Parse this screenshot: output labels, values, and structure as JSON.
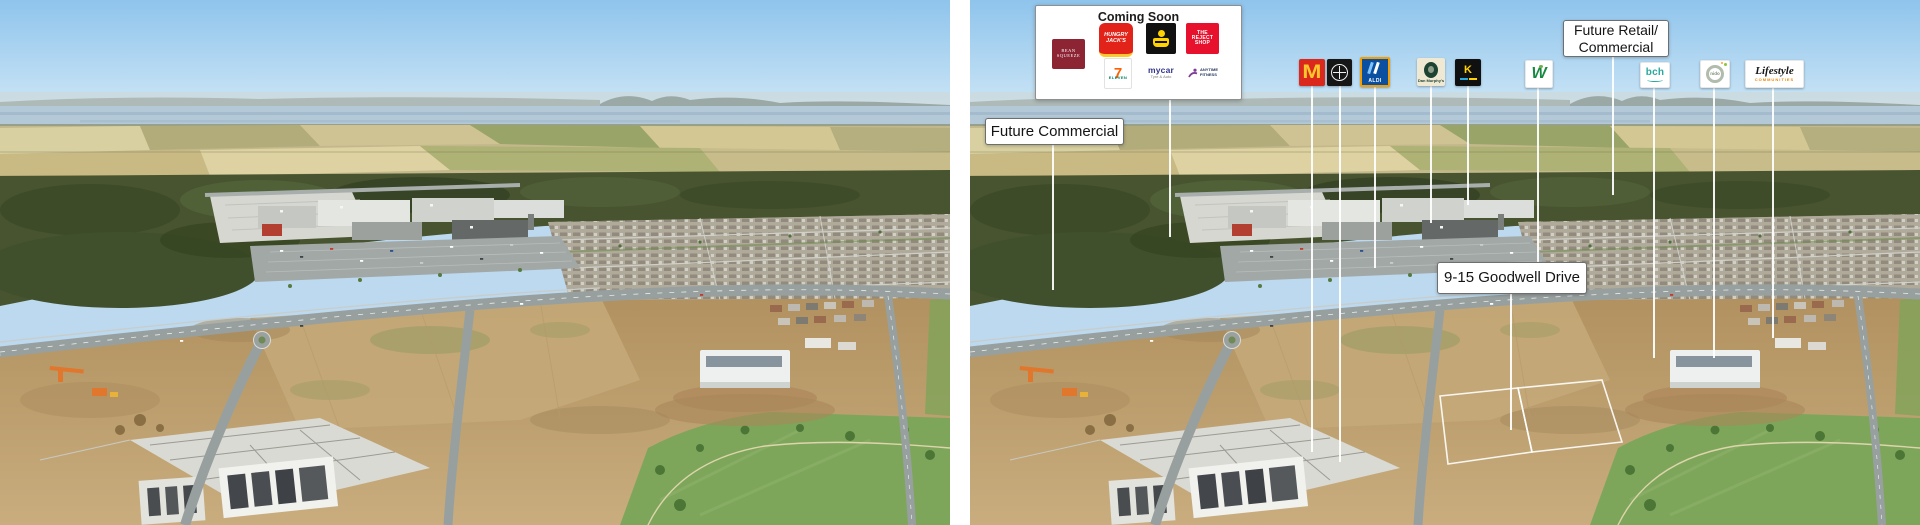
{
  "coming_soon": {
    "title": "Coming Soon",
    "logos": {
      "bean_squeeze": {
        "line1": "BEAN",
        "line2": "SQUEEZE"
      },
      "hungry_jacks": {
        "line1": "HUNGRY",
        "line2": "JACK'S"
      },
      "reject_shop": {
        "line1": "THE",
        "line2": "REJECT",
        "line3": "SHOP"
      },
      "seven_eleven": {
        "glyph": "7",
        "label": "ELEVEN"
      },
      "mycar": {
        "label": "mycar",
        "sub": "Tyre & Auto"
      },
      "anytime_fitness": {
        "line1": "ANYTIME",
        "line2": "FITNESS"
      }
    }
  },
  "callouts": {
    "future_commercial": "Future Commercial",
    "future_retail_line1": "Future Retail/",
    "future_retail_line2": "Commercial",
    "goodwell_drive": "9-15 Goodwell Drive"
  },
  "tenant_row": {
    "mcdonalds": {
      "glyph": "M"
    },
    "aldi": {
      "label": "ALDI"
    },
    "dan_murphys": {
      "label": "Dan Murphy's"
    },
    "k_brand": {
      "glyph": "K"
    },
    "woolworths": {
      "glyph": "W"
    },
    "bch": {
      "label": "bch"
    },
    "nido": {
      "label": "nido"
    },
    "lifestyle": {
      "label": "Lifestyle",
      "sub": "COMMUNITIES"
    }
  },
  "colors": {
    "mcdonalds_red": "#da291c",
    "mcdonalds_gold": "#ffc72c",
    "hungry_jacks_red": "#e2231a",
    "reject_shop_red": "#e8112d",
    "bean_squeeze_maroon": "#8c2433",
    "aldi_blue": "#0a4fa0",
    "aldi_orange": "#f59e00",
    "seven_eleven_green": "#008061",
    "seven_eleven_orange": "#ff5f00",
    "anytime_purple": "#7d3f98",
    "woolworths_green": "#178841",
    "bch_teal": "#2aa99f",
    "lifestyle_orange": "#f08300",
    "dan_murphys_green": "#1d4433",
    "leader_line": "#ffffff"
  }
}
